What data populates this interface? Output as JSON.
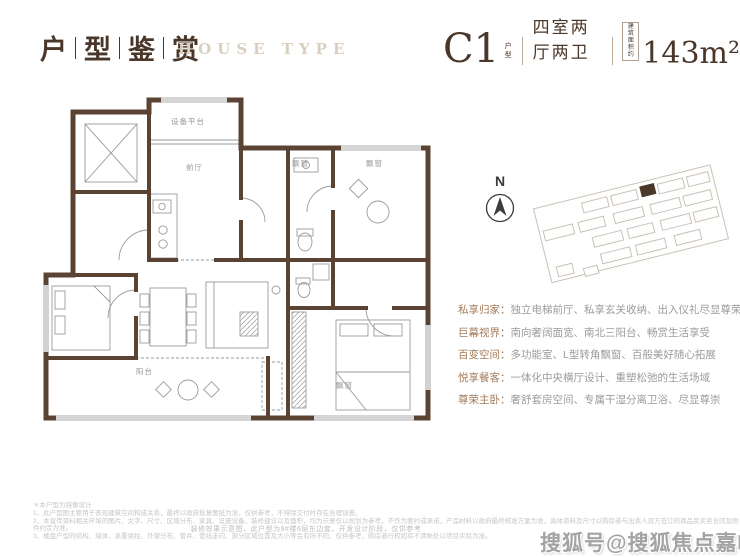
{
  "header": {
    "title_chars": [
      "户",
      "型",
      "鉴",
      "赏"
    ],
    "subtitle": "HOUSE TYPE",
    "unit": {
      "code": "C1",
      "code_label": "户型",
      "layout": "四室两厅两卫",
      "area_label_1": "建筑",
      "area_label_2": "面积约",
      "area_value": "143m²"
    }
  },
  "floorplan": {
    "labels": [
      "设备平台",
      "前厅",
      "飘窗",
      "飘窗",
      "阳台",
      "飘窗"
    ],
    "caption": "装修效果示意图，此户型为9#楼6层东边套，开发设计阶段，仅供参考"
  },
  "site": {
    "compass": "N"
  },
  "features": [
    {
      "label": "私享归家：",
      "text": "独立电梯前厅、私享玄关收纳、出入仪礼尽显尊荣"
    },
    {
      "label": "巨幕视界：",
      "text": "南向奢阔面宽、南北三阳台、畅赏生活享受"
    },
    {
      "label": "百变空间：",
      "text": "多功能室、L型转角飘窗、百般美好随心拓展"
    },
    {
      "label": "悦享餐客：",
      "text": "一体化中央横厅设计、重塑松弛的生活场域"
    },
    {
      "label": "尊荣主卧：",
      "text": "奢舒套房空间、专属干湿分离卫浴、尽显尊崇"
    }
  ],
  "footer": {
    "note_title": "＊本户型为镜像设计",
    "notes": [
      "1、此户型图主要用于表现建筑空间构成关系，最终以政府批复图纸为准，仅供参考，不排除交付时存在合理误差。",
      "2、本宣传资料相关环境的图片、文字、尺寸、区域分布、家具、设施设备、装修建议以及面积，均为示意仅以规划为参考，不作为要约或承诺，产品材料以政府最终核准方案为准，具体资料及尺寸以购房者与出卖人双方签订的商品房买卖合同及附件约定为准。",
      "3、楼盘户型的结构、墙体、承重梁柱、外窗分布、管井、管线走向，部分区域位置及大小等会有所不同，仅供参考，购房者行权如有不清晰处以项目实际为准。"
    ],
    "watermark": "搜狐号@搜狐焦点嘉峪关站"
  }
}
